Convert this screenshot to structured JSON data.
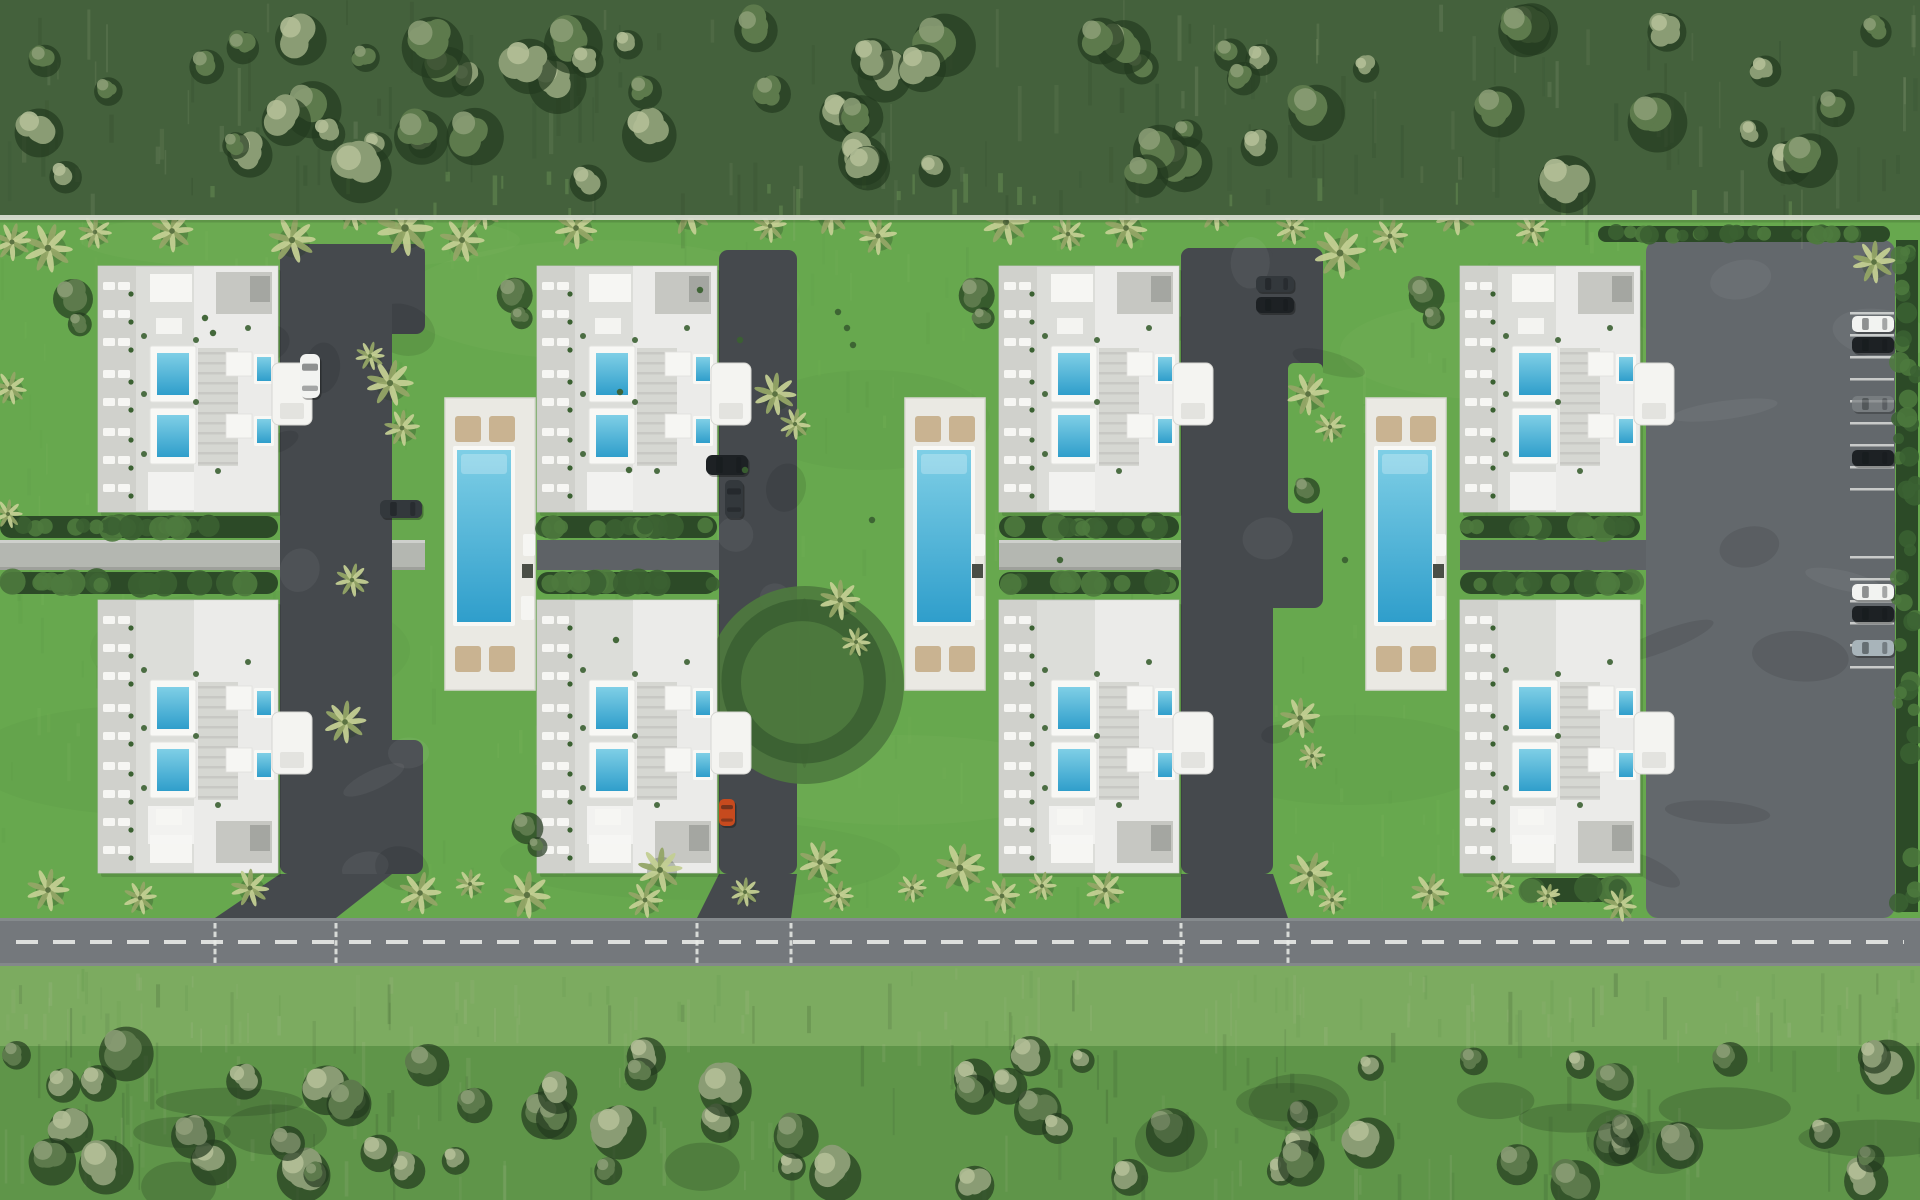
{
  "meta": {
    "title": "Aerial master-plan rendering of a villa community",
    "type": "aerial-site-plan",
    "visible_text": []
  },
  "scene": {
    "canvas": {
      "width": 1920,
      "height": 1200,
      "seed": 1337
    },
    "palette": {
      "grassBase": "#67a84e",
      "grassLight": "#8cc06a",
      "grassDark": "#4f8a3e",
      "line": "#d8dcd0",
      "forestTopBase": "#44613c",
      "southGrass": "#7cab60",
      "forestBottomBase": "#6d9d58",
      "treeShadow": "#243b20",
      "treeMid": "#5d7a4c",
      "treeLight": "#8a9c74",
      "treeHighlight": "#b2bf97",
      "palmLight": "#c3cf92",
      "palmMid": "#93a566",
      "palmDark": "#5c7342",
      "asphalt": "#45494d",
      "asphaltLight": "#5c6064",
      "lot": "#63686c",
      "road": "#74787c",
      "curb": "#8d9294",
      "marking": "#e9ebe8",
      "deck": "#eae9e3",
      "deckEdge": "#d9d8d1",
      "beige": "#c9b391",
      "roofBase": "#dcddd9",
      "roofApron": "#cfd0cb",
      "roofMid": "#c6c7c2",
      "roofDark": "#9b9d99",
      "roofWhite": "#f6f6f3",
      "roofLine": "#c0c1bc",
      "poolFrame": "#f8f8f5",
      "poolTop": "#7fcfe6",
      "poolDeep": "#2f9ecb",
      "hedgeDark": "#2c4a27",
      "hedgeMid": "#3b6132",
      "hedgeLight": "#4e7a3e",
      "walkLight": "#b4b7b1",
      "walkDark": "#5e6266",
      "carWhite": "#f2f3f1",
      "carBlack": "#1d2124",
      "carDark": "#33383c",
      "carGray": "#7e8386",
      "carSilver": "#a8b4ba",
      "carRed": "#c64a1e",
      "boxDark": "#4a4e46"
    },
    "bands": {
      "forestTop": {
        "y0": 0,
        "y1": 218
      },
      "boundaryLine": {
        "y": 215,
        "h": 5
      },
      "lawn": {
        "y0": 218,
        "y1": 918
      },
      "road": {
        "y0": 918,
        "h": 48,
        "centerY": 942,
        "dash": "22 15",
        "crossX": [
          215,
          336,
          697,
          791,
          1181,
          1288
        ]
      },
      "southGrass": {
        "y0": 966,
        "y1": 1046
      },
      "forestBottom": {
        "y0": 1046,
        "y1": 1200
      }
    },
    "building_geo": {
      "w": 180,
      "topY": 266,
      "topH": 246,
      "bottomY": 600,
      "bottomH": 273
    },
    "pool_geo": {
      "deckY": 398,
      "deckH": 292,
      "poolDX": 12,
      "poolW": 54,
      "poolDY": 52,
      "poolH": 172,
      "loungerXs": [
        10,
        44
      ],
      "loungerTopDY": 18,
      "loungerBottomDY": 248,
      "loungerSize": 26
    },
    "modules": [
      {
        "id": 1,
        "buildingX": 98,
        "pool": null,
        "walk": {
          "x": 0,
          "w": 425,
          "dark": false
        },
        "hedgeRows": [
          {
            "x": 0,
            "w": 278
          }
        ],
        "parkingPads": [
          [
            280,
            244,
            145,
            90
          ],
          [
            280,
            244,
            112,
            630
          ],
          [
            280,
            740,
            143,
            134
          ]
        ],
        "lawnNotches": [],
        "driveway": [
          [
            280,
            874
          ],
          [
            392,
            874
          ],
          [
            336,
            918
          ],
          [
            215,
            918
          ]
        ],
        "extraHedges": []
      },
      {
        "id": 2,
        "buildingX": 537,
        "pool": {
          "deckX": 445,
          "deckW": 90
        },
        "walk": {
          "x": 537,
          "w": 260,
          "dark": true
        },
        "hedgeRows": [
          {
            "x": 537,
            "w": 180
          }
        ],
        "parkingPads": [
          [
            719,
            250,
            78,
            624
          ]
        ],
        "lawnNotches": [],
        "driveway": [
          [
            719,
            874
          ],
          [
            797,
            874
          ],
          [
            791,
            918
          ],
          [
            697,
            918
          ]
        ],
        "extraHedges": [
          [
            798,
            598,
            13,
            170
          ]
        ]
      },
      {
        "id": 3,
        "buildingX": 999,
        "pool": {
          "deckX": 905,
          "deckW": 80
        },
        "walk": {
          "x": 999,
          "w": 324,
          "dark": false
        },
        "hedgeRows": [
          {
            "x": 999,
            "w": 180
          }
        ],
        "parkingPads": [
          [
            1181,
            248,
            142,
            360
          ],
          [
            1181,
            248,
            92,
            626
          ]
        ],
        "lawnNotches": [
          [
            1288,
            363,
            35,
            150
          ]
        ],
        "driveway": [
          [
            1181,
            874
          ],
          [
            1273,
            874
          ],
          [
            1288,
            918
          ],
          [
            1181,
            918
          ]
        ],
        "extraHedges": []
      },
      {
        "id": 4,
        "buildingX": 1460,
        "pool": {
          "deckX": 1366,
          "deckW": 80
        },
        "walk": {
          "x": 1460,
          "w": 435,
          "dark": true
        },
        "hedgeRows": [
          {
            "x": 1460,
            "w": 180
          }
        ],
        "parkingPads": [],
        "lawnNotches": [],
        "driveway": null,
        "extraHedges": [
          [
            1520,
            878,
            108,
            24
          ]
        ]
      }
    ],
    "lot": {
      "x": 1646,
      "y": 240,
      "w": 249,
      "h": 678,
      "topHedge": [
        1598,
        226,
        292,
        16
      ],
      "rightHedge": [
        1896,
        240,
        22,
        672
      ],
      "ticks": {
        "x": 1850,
        "w": 44,
        "ys": [
          312,
          334,
          356,
          378,
          400,
          422,
          444,
          466,
          488,
          556,
          578,
          600,
          622,
          644,
          666
        ]
      }
    },
    "cars": [
      {
        "x": 300,
        "y": 354,
        "w": 20,
        "h": 44,
        "color": "carWhite"
      },
      {
        "x": 380,
        "y": 500,
        "w": 42,
        "h": 18,
        "color": "carDark"
      },
      {
        "x": 706,
        "y": 455,
        "w": 42,
        "h": 20,
        "color": "carBlack"
      },
      {
        "x": 725,
        "y": 480,
        "w": 18,
        "h": 38,
        "color": "carDark"
      },
      {
        "x": 719,
        "y": 799,
        "w": 16,
        "h": 27,
        "color": "carRed"
      },
      {
        "x": 1256,
        "y": 276,
        "w": 38,
        "h": 16,
        "color": "carDark"
      },
      {
        "x": 1256,
        "y": 297,
        "w": 38,
        "h": 16,
        "color": "carBlack"
      },
      {
        "x": 1852,
        "y": 316,
        "w": 42,
        "h": 16,
        "color": "carWhite"
      },
      {
        "x": 1852,
        "y": 337,
        "w": 42,
        "h": 16,
        "color": "carBlack"
      },
      {
        "x": 1852,
        "y": 396,
        "w": 42,
        "h": 16,
        "color": "carGray",
        "opacity": 0.75
      },
      {
        "x": 1852,
        "y": 450,
        "w": 42,
        "h": 16,
        "color": "carBlack"
      },
      {
        "x": 1852,
        "y": 584,
        "w": 42,
        "h": 16,
        "color": "carWhite"
      },
      {
        "x": 1852,
        "y": 606,
        "w": 42,
        "h": 16,
        "color": "carBlack"
      },
      {
        "x": 1852,
        "y": 640,
        "w": 42,
        "h": 16,
        "color": "carSilver"
      }
    ],
    "palms": [
      [
        48,
        248,
        22
      ],
      [
        95,
        232,
        15
      ],
      [
        172,
        231,
        19
      ],
      [
        292,
        240,
        21
      ],
      [
        352,
        212,
        17
      ],
      [
        405,
        228,
        25
      ],
      [
        462,
        240,
        20
      ],
      [
        484,
        213,
        15
      ],
      [
        576,
        228,
        19
      ],
      [
        688,
        212,
        21
      ],
      [
        770,
        226,
        15
      ],
      [
        830,
        214,
        19
      ],
      [
        878,
        236,
        17
      ],
      [
        1006,
        222,
        21
      ],
      [
        1068,
        234,
        15
      ],
      [
        1126,
        228,
        19
      ],
      [
        1216,
        212,
        17
      ],
      [
        1292,
        228,
        15
      ],
      [
        1340,
        253,
        23
      ],
      [
        1390,
        236,
        16
      ],
      [
        1456,
        214,
        19
      ],
      [
        1532,
        230,
        15
      ],
      [
        1874,
        262,
        19
      ],
      [
        390,
        383,
        21
      ],
      [
        402,
        428,
        16
      ],
      [
        370,
        356,
        13
      ],
      [
        775,
        394,
        19
      ],
      [
        795,
        424,
        14
      ],
      [
        1308,
        394,
        19
      ],
      [
        1330,
        427,
        14
      ],
      [
        345,
        722,
        19
      ],
      [
        352,
        580,
        15
      ],
      [
        840,
        600,
        18
      ],
      [
        856,
        642,
        13
      ],
      [
        1300,
        718,
        18
      ],
      [
        1312,
        756,
        12
      ],
      [
        12,
        242,
        17
      ],
      [
        10,
        388,
        15
      ],
      [
        8,
        514,
        13
      ],
      [
        48,
        890,
        19
      ],
      [
        140,
        898,
        15
      ],
      [
        250,
        888,
        17
      ],
      [
        420,
        893,
        19
      ],
      [
        470,
        884,
        13
      ],
      [
        527,
        895,
        21
      ],
      [
        645,
        900,
        16
      ],
      [
        660,
        870,
        20
      ],
      [
        745,
        892,
        13
      ],
      [
        820,
        862,
        19
      ],
      [
        838,
        896,
        14
      ],
      [
        912,
        888,
        13
      ],
      [
        960,
        868,
        22
      ],
      [
        1002,
        896,
        16
      ],
      [
        1042,
        886,
        13
      ],
      [
        1105,
        890,
        17
      ],
      [
        1310,
        874,
        20
      ],
      [
        1332,
        900,
        13
      ],
      [
        1430,
        892,
        17
      ],
      [
        1500,
        886,
        13
      ],
      [
        1548,
        896,
        11
      ],
      [
        1620,
        905,
        15
      ]
    ],
    "bushes": [
      [
        70,
        295,
        20
      ],
      [
        78,
        322,
        12
      ],
      [
        512,
        292,
        18
      ],
      [
        520,
        316,
        11
      ],
      [
        974,
        292,
        18
      ],
      [
        982,
        316,
        11
      ],
      [
        1424,
        292,
        18
      ],
      [
        1432,
        316,
        11
      ],
      [
        1305,
        488,
        13
      ],
      [
        525,
        825,
        16
      ],
      [
        536,
        845,
        10
      ]
    ],
    "shrubs": [
      [
        205,
        318
      ],
      [
        213,
        333
      ],
      [
        838,
        312
      ],
      [
        847,
        328
      ],
      [
        853,
        345
      ],
      [
        620,
        392
      ],
      [
        629,
        470
      ],
      [
        1060,
        560
      ],
      [
        616,
        640
      ],
      [
        872,
        520
      ],
      [
        700,
        290
      ],
      [
        1345,
        560
      ],
      [
        740,
        340
      ],
      [
        745,
        470
      ]
    ],
    "mottle": {
      "dark": [
        [
          250,
          650,
          160,
          60
        ],
        [
          870,
          420,
          120,
          50
        ],
        [
          700,
          860,
          200,
          40
        ],
        [
          1350,
          760,
          140,
          45
        ],
        [
          150,
          760,
          180,
          55
        ]
      ],
      "light": [
        [
          600,
          300,
          200,
          60
        ],
        [
          1500,
          350,
          160,
          50
        ],
        [
          900,
          780,
          180,
          45
        ],
        [
          300,
          240,
          220,
          30
        ]
      ]
    },
    "forest": {
      "top": {
        "trees": 66,
        "streaks": 160,
        "lightRatio": 0.45
      },
      "bottom": {
        "trees": 64,
        "streaks": 180
      }
    }
  }
}
